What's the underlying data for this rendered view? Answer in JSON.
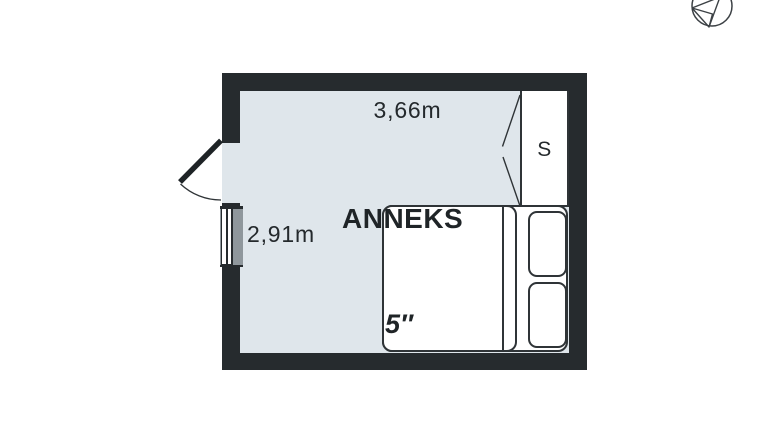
{
  "page": {
    "background": "#ffffff"
  },
  "colors": {
    "page_bg": "#ffffff",
    "wall": "#262b2e",
    "floor": "#dfe6eb",
    "outline": "#2f3437",
    "window_gray": "#8f979c",
    "text": "#24292c"
  },
  "floorplan": {
    "room": {
      "name": "ANNEKS",
      "width_label": "3,66m",
      "height_label": "2,91m",
      "bed_size_label": "5″"
    },
    "closet": {
      "label": "S"
    },
    "icons": {
      "compass_north_icon": "circle with paper-plane style north arrow, clipped at top edge",
      "entry_door_icon": "thick door leaf with quarter-circle swing arc",
      "window_icon": "double white glazing lines with gray sill",
      "closet_door_icon": "two diagonal swing lines"
    }
  }
}
